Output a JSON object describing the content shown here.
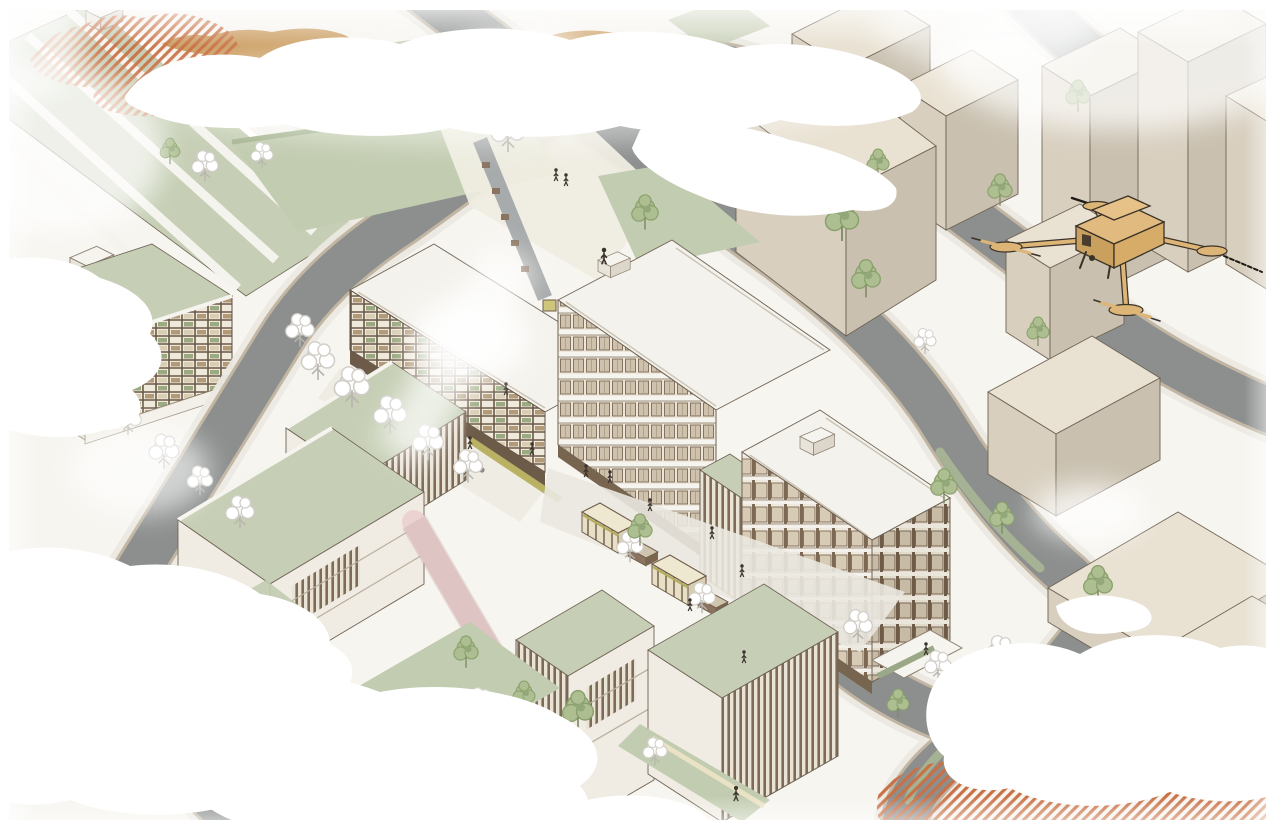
{
  "meta": {
    "description": "Axonometric architectural rendering of a mixed-use urban block: white and beige buildings with brown window grids, green roofs and lawns, street market stalls, pink elevated walkways, sketchy trees and pedestrians, fog clouds and terracotta hatched patches at the corners, and a tan quadcopter drone flying over context towers at the upper right.",
    "width_px": 1280,
    "height_px": 836
  },
  "labels": {
    "scene": "axonometric-urban-rendering",
    "drone": "quadcopter-drone",
    "main_complex": "mixed-use-perimeter-block",
    "market": "street-market-stalls",
    "park": "pocket-park",
    "terrace": "restaurant-terrace",
    "walkways": "pink-elevated-walkways",
    "clouds": "fog-cloud-overlay",
    "hatch": "terracotta-hatched-ground",
    "context": "context-towers"
  },
  "palette": {
    "paper": "#f7f5f0",
    "road": "#8c8f8e",
    "sidewalk": "#ebe9e2",
    "curb": "#c2b6a3",
    "lawn": "#c2ccb0",
    "roof_green": "#c6cfb5",
    "roof_white": "#f4f2ec",
    "context_beige": "#e9e2d3",
    "context_side": "#d8cfbf",
    "context_dark": "#c9c0af",
    "wood": "#6e5a48",
    "facade_glass": "#cfc2ac",
    "tan": "#cda167",
    "hatch_orange": "#c97146",
    "pink_walkway": "#ecd3d2",
    "stall_cream": "#efe8d0",
    "stall_olive": "#b5ad5e",
    "cloud": "#ffffff",
    "drone_tan": "#dcb577",
    "outline": "#6f6254",
    "tree_green": "#adbe90",
    "tree_white": "#ffffff",
    "figure_dark": "#3a332c"
  }
}
